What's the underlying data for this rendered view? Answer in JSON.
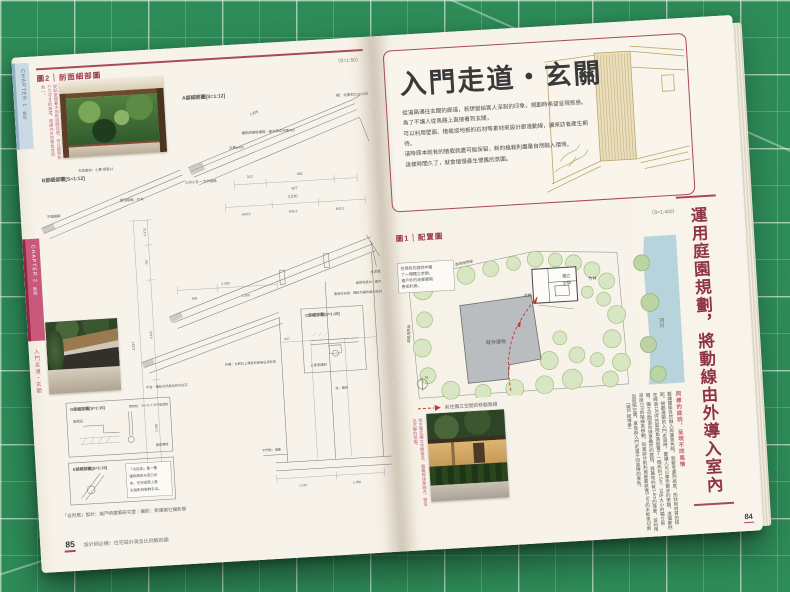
{
  "colors": {
    "mat_green": "#2e8c58",
    "paper": "#f7f3ea",
    "accent_red": "#a84a5a",
    "caption_pink": "#c2607a",
    "plan_tree_green": "#d8e6c3",
    "plan_building_gray": "#b9bdbf",
    "plan_river_blue": "#b7d4dd",
    "sketch_tan": "#b9a15e"
  },
  "left_page": {
    "chapter1_label": "CHAPTER 1",
    "chapter1_sub": "格局",
    "chapter2_label": "CHAPTER 2",
    "chapter2_sub": "動線",
    "side_label": "入門走道・玄關",
    "figure_badge": "圖2",
    "figure_sep": "｜",
    "figure_title": "剖面細部圖",
    "scale": "（S=1:50）",
    "photo_caption": "從臥室隔著木地板迴廊仰望，可以感受到2,175mm的高度，視線內外的景色合而為一。",
    "diagrams": {
      "a_label": "A部細部圖[S=1:12]",
      "b_label": "B部細部圖[S=1:12]",
      "c_label": "C部細部圖[S=1:15]",
      "d_label": "D部細部圖[S=1:15]",
      "e_label": "E部細部圖[S=1:15]",
      "dims": [
        "2,530",
        "843.3",
        "843.3",
        "843.3",
        "2,150",
        "800",
        "1,350",
        "627",
        "1,222",
        "1,350",
        "4,237",
        "3,115",
        "1,760",
        "757",
        "1,372",
        "212",
        "452",
        "827",
        "1,835"
      ],
      "materials": [
        "樑：北美材210×120",
        "鍍鋁鋅鋼板橫葺：椽木厚石材板455",
        "瓦棒φ455",
        "三州小瓦 一文字葺鋪",
        "不鏽鋼網",
        "天花板材：小舞 厚度12",
        "屋頂收邊材：扁木",
        "簷廊天花板：繩紋竹編的屋木底材",
        "上等瓷磚材",
        "水泥板",
        "屋頂底板：杉木",
        "外牆：水刷石上薄塗砂漿後石灰刷漆",
        "平台：鋪設天然風化的大谷石",
        "沓脫石",
        "鋼管柱：75×75 十文字型底板",
        "固定螺栓",
        "下門框：湘桑",
        "柱：扁柏"
      ],
      "note_lines": [
        "「出目皮」是一種",
        "讓表面的水泥凸出",
        "來，在完成面上產",
        "生陰影的裝飾手法。"
      ]
    },
    "credit": "「自然居」設計：城戸崎建築研究室｜攝影：新建築社攝影部",
    "page_number": "85",
    "footer_tagline": "設計師必備！住宅設計黃金比例解剖圖"
  },
  "right_page": {
    "title": "入門走道・玄關",
    "intro_lines": [
      "從道路通往玄關的廊道，若想留給客人深刻的印象，規劃時希望呈現質感。",
      "為了不讓人從馬路上直接看到玄關，",
      "可以利用壁面、植栽或地板的石材等素材來設計廊道動線，讓來訪者產生期待。",
      "這時原本就有的植栽就盡可能保留，新的植栽則盡量自然融入環境。",
      "這樣時間久了，就會慢慢產生懷舊的氛圍。"
    ],
    "figure_badge": "圖1",
    "figure_sep": "｜",
    "figure_title": "配置圖",
    "scale": "（S=1:400）",
    "plan": {
      "note_lines": [
        "在現有的庭院中蓋",
        "了一個獨立空間，",
        "連戶外的走廊都能",
        "善加利用。"
      ],
      "labels": {
        "existing": "既存建物",
        "independent1": "獨立",
        "independent2": "空間",
        "entrance": "玄關",
        "bamboo": "竹林",
        "river": "河川",
        "boundary_top": "鄰地境界線",
        "boundary_left": "道路境界線",
        "north": "N"
      },
      "legend": "前往獨立空間的移動路線"
    },
    "photo_caption": "從主屋往獨立空間望去，圍籬與綠意融合，營造出沉靜的氛圍。",
    "column_heading": "同樣的庭院，呈現不同風情",
    "column_body": "要讓建築自然融入周邊景色時，就要考慮到高度、形狀和材質的搭配。規劃建築的入門走道時，要讓人可以享受散步的樂趣。這個案例在經過130坪的庭院角落設置了一個高約1.5m、10坪大小的獨立房間，獨立空間面向綠意盎然的庭院，與基地約有1.6m的落差，並利用深度215的階梯來移動。和室部分則利用屋簷與寬1.5m的木板來切割出庭院空間，享受與入門走道不同風情的景色。",
    "column_credit": "〔城戸崎博孝〕",
    "vertical_title": "運用庭園規劃，將動線由外導入室內",
    "page_number": "84"
  }
}
